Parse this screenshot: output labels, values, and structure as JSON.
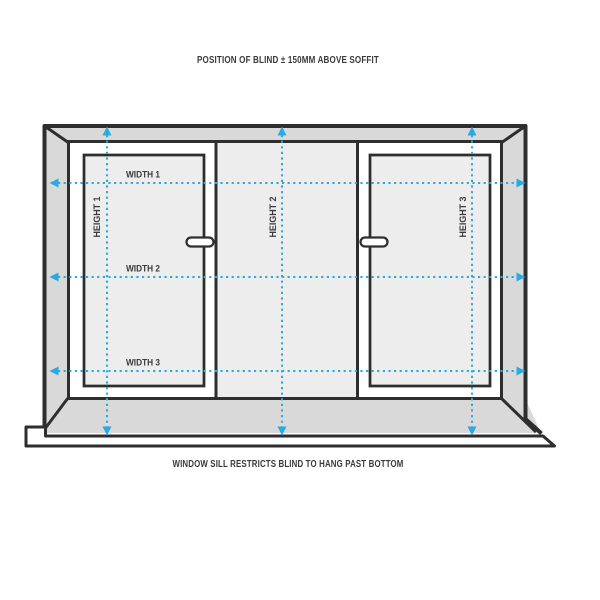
{
  "diagram": {
    "title": "window blind measuring guide",
    "captions": {
      "top": "POSITION OF BLIND ± 150MM ABOVE SOFFIT",
      "bottom": "WINDOW SILL RESTRICTS BLIND TO HANG PAST BOTTOM"
    },
    "width_labels": [
      "WIDTH 1",
      "WIDTH 2",
      "WIDTH 3"
    ],
    "height_labels": [
      "HEIGHT 1",
      "HEIGHT 2",
      "HEIGHT 3"
    ]
  },
  "colors": {
    "outline": "#2e2e2e",
    "wall_gray": "#d9d9d9",
    "glass_gray": "#ededed",
    "measure_blue": "#29abe2",
    "label_text": "#3a3a3a",
    "background": "#ffffff"
  }
}
